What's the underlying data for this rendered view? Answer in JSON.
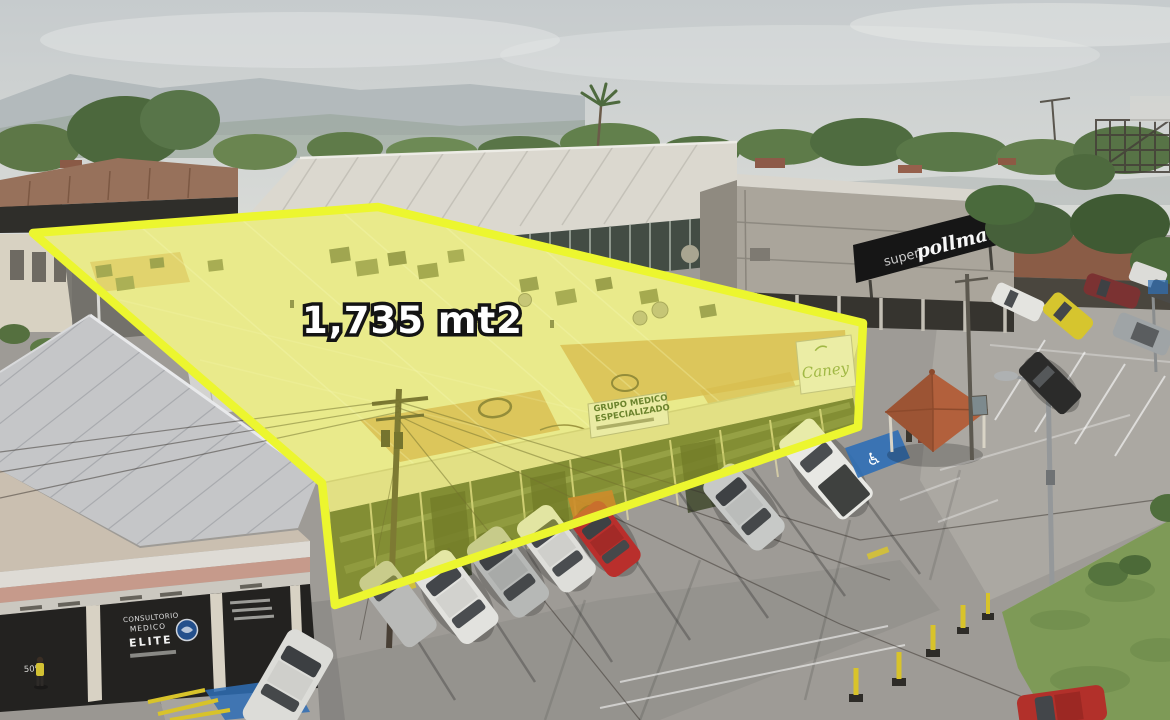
{
  "annotation": {
    "area_label": "1,735 mt2",
    "outline_color": "#ecf62f",
    "fill_color": "rgba(234,242,48,0.33)"
  },
  "signs": {
    "supermarket": {
      "prefix": "super",
      "name": "pollmart"
    },
    "building_logo": "Caney",
    "facade_sign": {
      "line1": "GRUPO MEDICO",
      "line2": "ESPECIALIZADO"
    },
    "storefront": {
      "line1": "CONSULTORIO",
      "line2": "MEDICO",
      "line3": "ELITE",
      "promo": "50%"
    },
    "accessible_parking_symbol": "♿"
  }
}
